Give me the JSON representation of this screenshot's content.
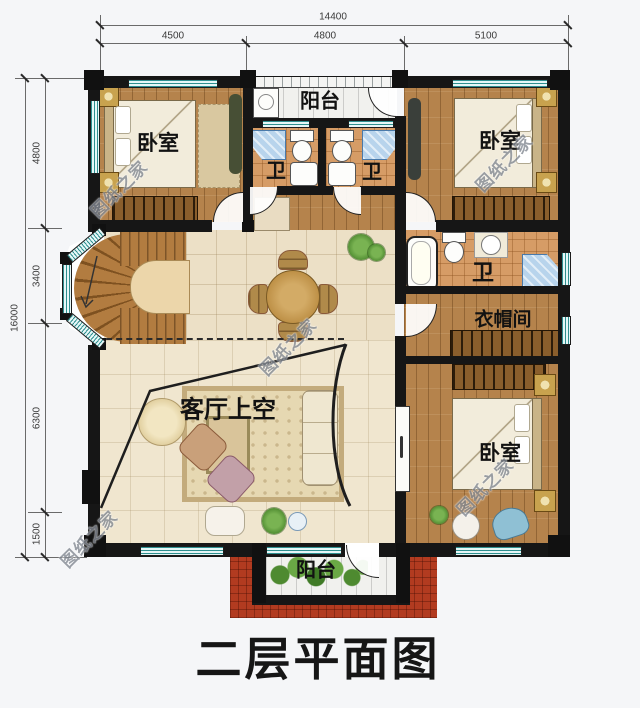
{
  "title": "二层平面图",
  "watermark": {
    "text": "图纸之家"
  },
  "dimensions": {
    "top": {
      "total": "14400",
      "segments": [
        "4500",
        "4800",
        "5100"
      ]
    },
    "left": {
      "total": "16000",
      "segments": [
        "4800",
        "3400",
        "6300",
        "1500"
      ]
    }
  },
  "rooms": {
    "bedroom_top_left": {
      "label": "卧室"
    },
    "bedroom_top_right": {
      "label": "卧室"
    },
    "bedroom_bottom_right": {
      "label": "卧室"
    },
    "bathroom_left": {
      "label": "卫"
    },
    "bathroom_right": {
      "label": "卫"
    },
    "bathroom_master": {
      "label": "卫"
    },
    "balcony_top": {
      "label": "阳台"
    },
    "balcony_bottom": {
      "label": "阳台"
    },
    "cloakroom": {
      "label": "衣帽间"
    },
    "living_void": {
      "label": "客厅上空"
    }
  },
  "colors": {
    "wall": "#161616",
    "window_teal": "#2e8f8f",
    "roof_red": "#b23b20",
    "wood_floor": "#b5834c",
    "tile_cream": "#ece0c6",
    "bath_tile": "#d69c66",
    "shower_blue": "#b8d4ec"
  }
}
